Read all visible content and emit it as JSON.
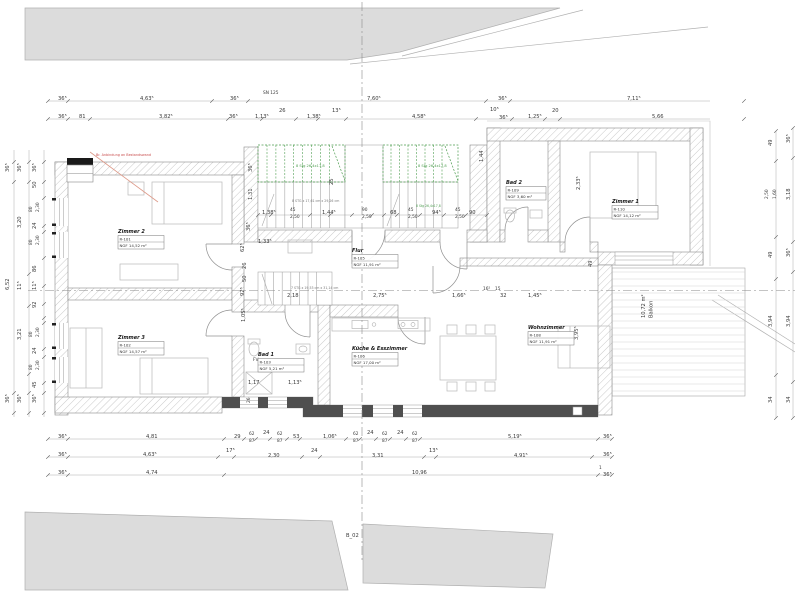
{
  "colors": {
    "neighbor_fill": "#dcdcdc",
    "wall_dark": "#4f4f4f",
    "stair_green": "#4e9d50",
    "annotation_red": "#c94f4f",
    "dim_text": "#3a3a3a"
  },
  "plan": {
    "section_label": "B_02",
    "red_note": "Br. Anbindung an Bestandswand",
    "balkon": {
      "area": "10,72 m²",
      "label": "Balkon"
    },
    "rooms": [
      {
        "name": "Zimmer 2",
        "number": "R-101",
        "area": "NGF  14,52 m²",
        "x": 118,
        "y": 233
      },
      {
        "name": "Zimmer 3",
        "number": "R-102",
        "area": "NGF  14,57 m²",
        "x": 118,
        "y": 339
      },
      {
        "name": "Bad 1",
        "number": "R-103",
        "area": "NGF  5,21 m²",
        "x": 258,
        "y": 356
      },
      {
        "name": "Flur",
        "number": "R-105",
        "area": "NGF  11,91 m²",
        "x": 352,
        "y": 252
      },
      {
        "name": "Küche & Esszimmer",
        "number": "R-106",
        "area": "NGF  17,00 m²",
        "x": 352,
        "y": 350
      },
      {
        "name": "Wohnzimmer",
        "number": "R-108",
        "area": "NGF  11,91 m²",
        "x": 528,
        "y": 329
      },
      {
        "name": "Zimmer 1",
        "number": "R-110",
        "area": "NGF  14,12 m²",
        "x": 612,
        "y": 203
      },
      {
        "name": "Bad 2",
        "number": "R-109",
        "area": "NGF  3,60 m²",
        "x": 506,
        "y": 184,
        "w": 40
      }
    ],
    "stair_texts": [
      [
        296,
        167,
        "8 Stg 26,4x17,8",
        "g"
      ],
      [
        418,
        167,
        "8 Stg 26,4x17,8",
        "g"
      ],
      [
        416,
        207,
        "8 Stg 26,4x17,8",
        "gt"
      ],
      [
        292,
        202,
        "8 STG x 17,61 cm x 29,26 cm",
        "s"
      ],
      [
        291,
        289,
        "7 STG x 19,53 cm x 31,14 cm",
        "s"
      ]
    ],
    "dim_labels": [
      [
        58,
        100,
        "36⁵"
      ],
      [
        140,
        100,
        "4,63⁵"
      ],
      [
        230,
        100,
        "36⁵"
      ],
      [
        367,
        100,
        "7,60⁵"
      ],
      [
        498,
        100,
        "36⁵"
      ],
      [
        627,
        100,
        "7,11⁵"
      ],
      [
        263,
        94,
        "SN 125",
        "t"
      ],
      [
        58,
        118,
        "36⁵"
      ],
      [
        79,
        118,
        "81"
      ],
      [
        159,
        118,
        "3,82⁵"
      ],
      [
        229,
        118,
        "36⁵"
      ],
      [
        255,
        118,
        "1,13⁵"
      ],
      [
        279,
        112,
        "26"
      ],
      [
        307,
        118,
        "1,38⁵"
      ],
      [
        332,
        112,
        "13⁵"
      ],
      [
        412,
        118,
        "4,58⁵"
      ],
      [
        490,
        111,
        "10⁵"
      ],
      [
        499,
        119,
        "36⁵"
      ],
      [
        528,
        118,
        "1,25⁵"
      ],
      [
        552,
        112,
        "20"
      ],
      [
        652,
        118,
        "5,66"
      ],
      [
        58,
        438,
        "36⁵"
      ],
      [
        146,
        438,
        "4,81"
      ],
      [
        234,
        438,
        "29"
      ],
      [
        249,
        435,
        "62",
        "t"
      ],
      [
        249,
        442,
        "87",
        "t"
      ],
      [
        263,
        434,
        "24"
      ],
      [
        277,
        435,
        "62",
        "t"
      ],
      [
        277,
        442,
        "87",
        "t"
      ],
      [
        293,
        438,
        "53"
      ],
      [
        323,
        438,
        "1,06⁵"
      ],
      [
        353,
        435,
        "62",
        "t"
      ],
      [
        353,
        442,
        "87",
        "t"
      ],
      [
        367,
        434,
        "24"
      ],
      [
        382,
        435,
        "62",
        "t"
      ],
      [
        382,
        442,
        "87",
        "t"
      ],
      [
        397,
        434,
        "24"
      ],
      [
        412,
        435,
        "62",
        "t"
      ],
      [
        412,
        442,
        "87",
        "t"
      ],
      [
        508,
        438,
        "5,19⁵"
      ],
      [
        603,
        438,
        "36⁵"
      ],
      [
        58,
        456,
        "36⁵"
      ],
      [
        143,
        456,
        "4,63⁵"
      ],
      [
        226,
        452,
        "17⁵"
      ],
      [
        268,
        457,
        "2,30"
      ],
      [
        311,
        452,
        "24"
      ],
      [
        372,
        457,
        "3,31"
      ],
      [
        429,
        452,
        "13⁵"
      ],
      [
        514,
        457,
        "4,91⁵"
      ],
      [
        603,
        456,
        "36⁵"
      ],
      [
        58,
        474,
        "36⁵"
      ],
      [
        146,
        474,
        "4,74"
      ],
      [
        412,
        474,
        "10,96"
      ],
      [
        599,
        469,
        "1",
        "t"
      ],
      [
        603,
        476,
        "36⁵"
      ],
      [
        9,
        172,
        "36⁵",
        "v"
      ],
      [
        9,
        290,
        "6,52",
        "v"
      ],
      [
        9,
        403,
        "36⁵",
        "v"
      ],
      [
        21,
        172,
        "36⁵",
        "v"
      ],
      [
        21,
        228,
        "3,20",
        "v"
      ],
      [
        21,
        290,
        "11⁵",
        "v"
      ],
      [
        21,
        340,
        "3,21",
        "v"
      ],
      [
        21,
        403,
        "36⁵",
        "v"
      ],
      [
        36,
        172,
        "36⁵",
        "v"
      ],
      [
        36,
        188,
        "50",
        "v"
      ],
      [
        32,
        212,
        "80",
        "vt"
      ],
      [
        39,
        212,
        "2,30",
        "vt"
      ],
      [
        36,
        229,
        "24",
        "v"
      ],
      [
        32,
        245,
        "80",
        "vt"
      ],
      [
        39,
        245,
        "2,30",
        "vt"
      ],
      [
        36,
        272,
        "86",
        "v"
      ],
      [
        36,
        290,
        "11⁵",
        "v"
      ],
      [
        36,
        308,
        "92",
        "v"
      ],
      [
        32,
        337,
        "80",
        "vt"
      ],
      [
        39,
        337,
        "2,30",
        "vt"
      ],
      [
        36,
        354,
        "24",
        "v"
      ],
      [
        32,
        370,
        "80",
        "vt"
      ],
      [
        39,
        370,
        "2,30",
        "vt"
      ],
      [
        36,
        388,
        "45",
        "v"
      ],
      [
        36,
        403,
        "36⁵",
        "v"
      ],
      [
        772,
        146,
        "49",
        "v"
      ],
      [
        768,
        199,
        "2,50",
        "vt"
      ],
      [
        776,
        199,
        "1,60",
        "vt"
      ],
      [
        772,
        258,
        "49",
        "v"
      ],
      [
        772,
        327,
        "3,94",
        "v"
      ],
      [
        772,
        403,
        "34",
        "v"
      ],
      [
        790,
        143,
        "36⁵",
        "v"
      ],
      [
        790,
        200,
        "3,18",
        "v"
      ],
      [
        790,
        257,
        "36⁵",
        "v"
      ],
      [
        790,
        327,
        "3,94",
        "v"
      ],
      [
        790,
        403,
        "34",
        "v"
      ],
      [
        262,
        214,
        "1,38⁵"
      ],
      [
        290,
        211,
        "45",
        "t"
      ],
      [
        290,
        218,
        "2,50",
        "t"
      ],
      [
        322,
        214,
        "1,44⁵"
      ],
      [
        362,
        211,
        "90",
        "t"
      ],
      [
        362,
        218,
        "2,50",
        "t"
      ],
      [
        390,
        214,
        "68"
      ],
      [
        408,
        211,
        "45",
        "t"
      ],
      [
        408,
        218,
        "2,50",
        "t"
      ],
      [
        432,
        214,
        "94⁵"
      ],
      [
        455,
        211,
        "45",
        "t"
      ],
      [
        455,
        218,
        "2,50",
        "t"
      ],
      [
        469,
        214,
        "90"
      ],
      [
        333,
        185,
        "25",
        "v"
      ],
      [
        252,
        172,
        "36⁵",
        "v"
      ],
      [
        252,
        200,
        "1,31",
        "v"
      ],
      [
        250,
        231,
        "36⁵",
        "v"
      ],
      [
        244,
        252,
        "62⁵",
        "v"
      ],
      [
        246,
        269,
        "26",
        "v"
      ],
      [
        246,
        282,
        "50",
        "v"
      ],
      [
        244,
        296,
        "92⁵",
        "v"
      ],
      [
        245,
        322,
        "1,05⁵",
        "v"
      ],
      [
        578,
        340,
        "3,95⁵",
        "v"
      ],
      [
        483,
        162,
        "1,44",
        "v"
      ],
      [
        580,
        190,
        "2,33⁵",
        "v"
      ],
      [
        592,
        267,
        "49",
        "v"
      ],
      [
        250,
        403,
        "26",
        "vt"
      ],
      [
        258,
        243,
        "1,33⁵"
      ],
      [
        287,
        297,
        "2,18"
      ],
      [
        373,
        297,
        "2,75⁵"
      ],
      [
        452,
        297,
        "1,66⁵"
      ],
      [
        483,
        290,
        "16⁵",
        "t"
      ],
      [
        495,
        290,
        "15",
        "t"
      ],
      [
        500,
        297,
        "32"
      ],
      [
        528,
        297,
        "1,45⁵"
      ],
      [
        248,
        384,
        "1,17"
      ],
      [
        288,
        384,
        "1,13⁵"
      ],
      [
        253,
        361,
        "FV",
        "t"
      ]
    ]
  }
}
